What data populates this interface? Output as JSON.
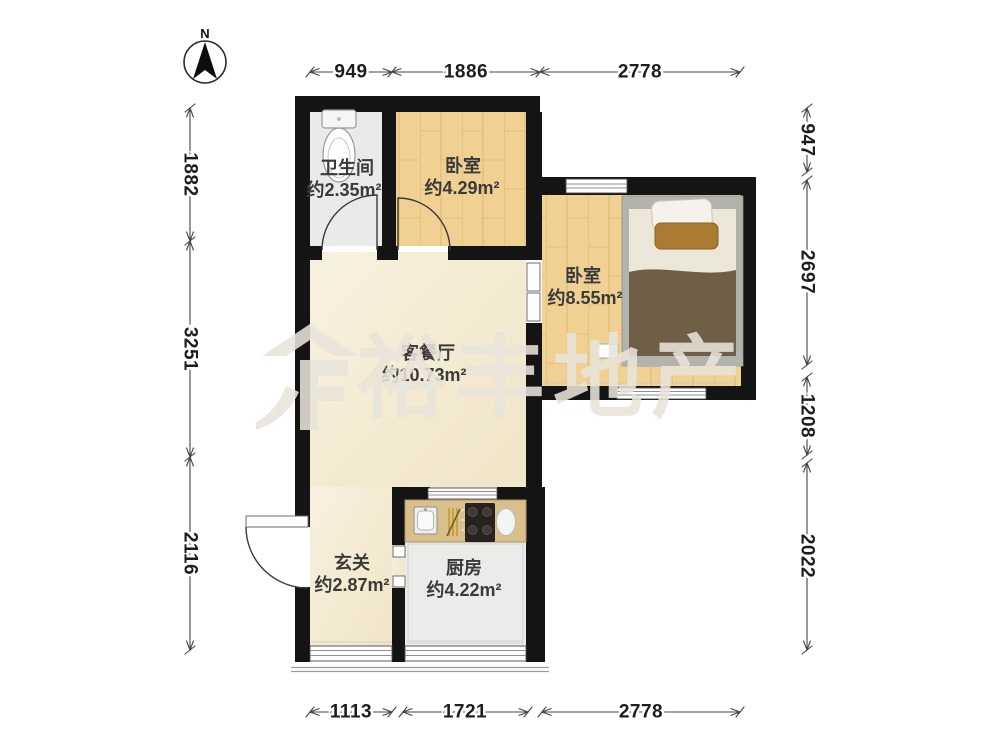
{
  "compass": {
    "label": "N"
  },
  "watermark": {
    "text": "裕丰地产"
  },
  "rooms": {
    "bathroom": {
      "name": "卫生间",
      "area": "约2.35m²"
    },
    "bedroom1": {
      "name": "卧室",
      "area": "约4.29m²"
    },
    "bedroom2": {
      "name": "卧室",
      "area": "约8.55m²"
    },
    "living": {
      "name": "客餐厅",
      "area": "约10.73m²"
    },
    "entry": {
      "name": "玄关",
      "area": "约2.87m²"
    },
    "kitchen": {
      "name": "厨房",
      "area": "约4.22m²"
    }
  },
  "dims": {
    "top": [
      "949",
      "1886",
      "2778"
    ],
    "left": [
      "1882",
      "3251",
      "2116"
    ],
    "right": [
      "947",
      "2697",
      "1208",
      "2022"
    ],
    "bottom": [
      "1113",
      "1721",
      "2778"
    ]
  },
  "colors": {
    "wall": "#141414",
    "wood_floor": "#f1d093",
    "marble_floor": "#f7efdb",
    "tile_floor": "#ebebe9",
    "counter": "#d8bf8c",
    "blanket": "#6f5f46"
  }
}
